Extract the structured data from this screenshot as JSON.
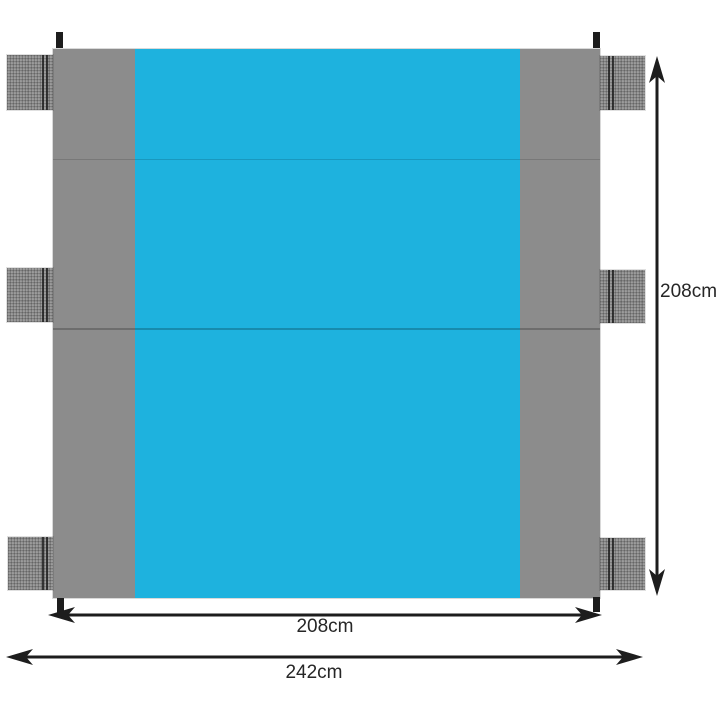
{
  "diagram": {
    "type": "product-dimension-diagram",
    "dimensions": {
      "height_label": "208cm",
      "inner_width_label": "208cm",
      "total_width_label": "242cm"
    },
    "colors": {
      "background": "#ffffff",
      "blanket_blue": "#1eb2de",
      "blanket_gray": "#8c8c8c",
      "pocket_gray": "#929292",
      "dimension_line": "#1d1d1d",
      "label_text": "#262626"
    },
    "icons": {
      "arrowheads": [
        "arrowhead-up-icon",
        "arrowhead-down-icon",
        "arrowhead-left-icon",
        "arrowhead-right-icon"
      ]
    }
  }
}
